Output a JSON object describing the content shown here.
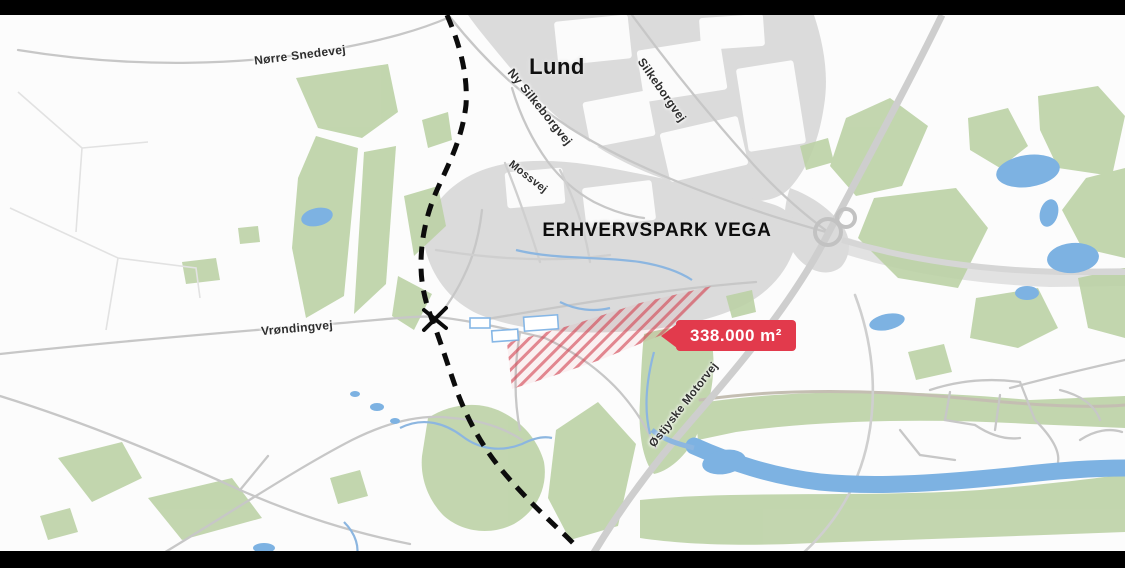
{
  "map": {
    "town_label": "Lund",
    "park_label": "ERHVERVSPARK VEGA",
    "area_badge": {
      "text": "338.000 m²",
      "color": "#e23a4c"
    },
    "road_labels": [
      {
        "id": "norre-snedevej",
        "text": "Nørre Snedevej"
      },
      {
        "id": "ny-silkeborgvej",
        "text": "Ny Silkeborgvej"
      },
      {
        "id": "silkeborgvej",
        "text": "Silkeborgvej"
      },
      {
        "id": "mossvej",
        "text": "Mossvej"
      },
      {
        "id": "vrondingvej",
        "text": "Vrøndingvej"
      },
      {
        "id": "ostjyske-motorvej",
        "text": "Østjyske Motorvej"
      }
    ],
    "legend_colors": {
      "urban_area": "#dbdbdb",
      "green_area": "#bcd2a6",
      "water": "#7db2e2",
      "road": "#c7c7c7",
      "site_boundary_dash": "#0c0c0c",
      "available_plot_hatch": "#d34652",
      "letterbox": "#000000"
    }
  }
}
